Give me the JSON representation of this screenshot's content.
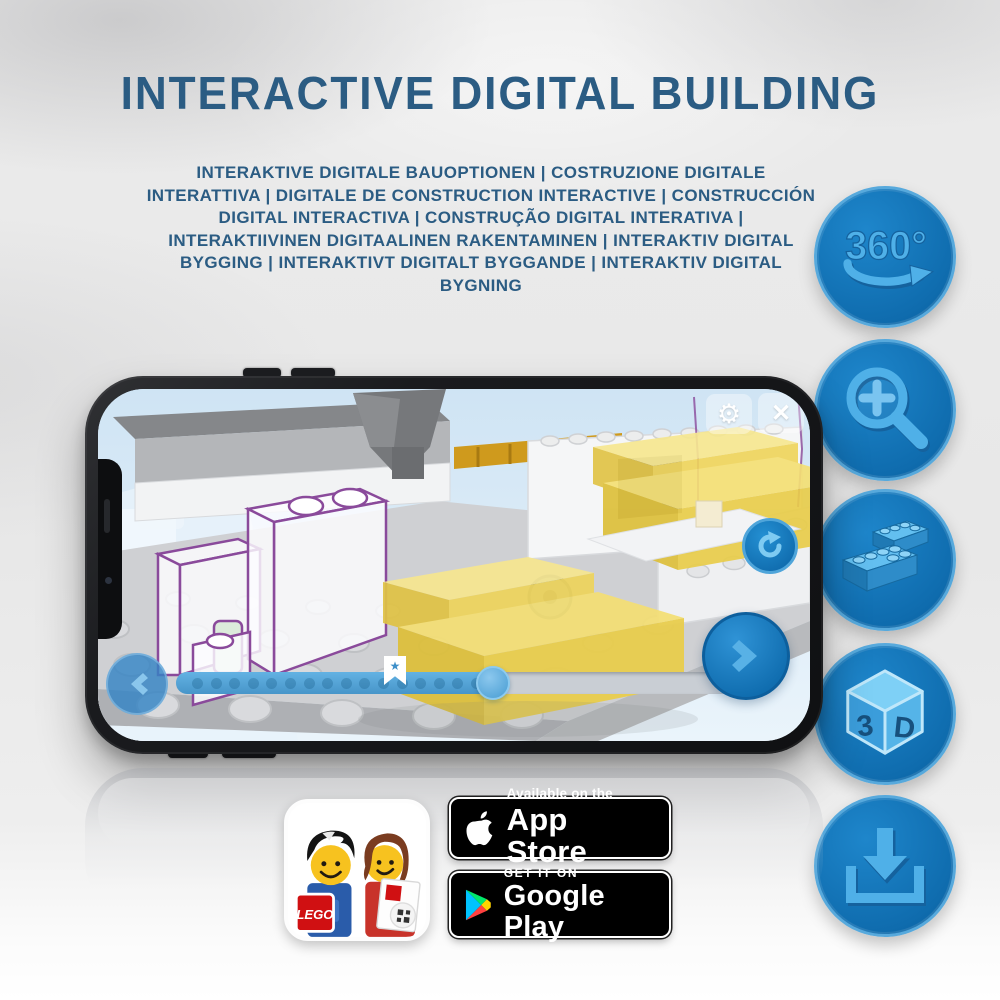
{
  "page": {
    "title": "INTERACTIVE DIGITAL BUILDING",
    "subtitle": "INTERAKTIVE DIGITALE BAUOPTIONEN | COSTRUZIONE DIGITALE INTERATTIVA | DIGITALE DE CONSTRUCTION INTERACTIVE | CONSTRUCCIÓN DIGITAL INTERACTIVA | CONSTRUÇÃO DIGITAL INTERATIVA | INTERAKTIIVINEN DIGITAALINEN RAKENTAMINEN | INTERAKTIV DIGITAL BYGGING | INTERAKTIVT DIGITALT BYGGANDE | INTERAKTIV DIGITAL BYGNING"
  },
  "feature_rail": {
    "rotation_label": "360°",
    "cube_left": "3",
    "cube_right": "D",
    "icon_names": [
      "360-rotation",
      "zoom-in",
      "lego-bricks",
      "3d-cube",
      "download"
    ]
  },
  "phone_app": {
    "progress_fraction": 0.55,
    "progress_dot_count": 16,
    "controls": [
      "settings",
      "close",
      "rotate",
      "previous-step",
      "next-step",
      "step-slider",
      "bookmark"
    ]
  },
  "icons": {
    "gear": "⚙",
    "close": "✕",
    "bookmark_star": "★"
  },
  "badges": {
    "app_store": {
      "line1": "Available on the",
      "line2": "App Store"
    },
    "google_play": {
      "line1": "GET IT ON",
      "line2": "Google Play"
    },
    "lego_logo": "LEGO"
  },
  "colors": {
    "heading_blue": "#2b5c83",
    "icon_circle_blue": "#0f6cae",
    "icon_glyph_blue": "#4fb0e8",
    "slider_blue": "#55a6d9",
    "brick_yellow": "#f4df74",
    "ghost_outline_purple": "#8a4a9b",
    "badge_black": "#000000"
  }
}
